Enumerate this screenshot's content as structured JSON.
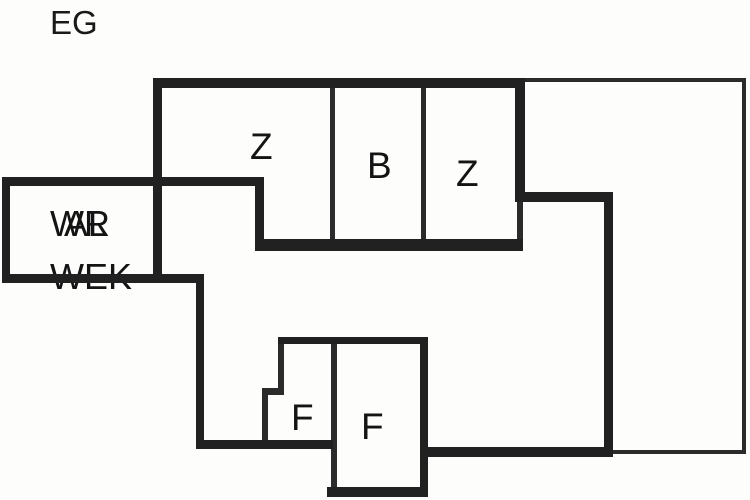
{
  "floorplan": {
    "floor_label": "EG",
    "labels": {
      "room_z1": "Z",
      "room_b": "B",
      "room_z2": "Z",
      "room_f1": "F",
      "room_f2": "F",
      "left_room_overlap_top": "WR",
      "left_room_overlap_bottom": "AL",
      "left_room_lower": "WEK"
    },
    "rooms": [
      {
        "id": "z1",
        "label": "Z"
      },
      {
        "id": "b",
        "label": "B"
      },
      {
        "id": "z2",
        "label": "Z"
      },
      {
        "id": "f1",
        "label": "F"
      },
      {
        "id": "f2",
        "label": "F"
      },
      {
        "id": "left-room",
        "label": "WR / AL / WEK"
      }
    ],
    "colors": {
      "wall": "#212121",
      "thin_line": "#2b2b2b",
      "background": "#fdfdfb",
      "text": "#141414"
    }
  }
}
